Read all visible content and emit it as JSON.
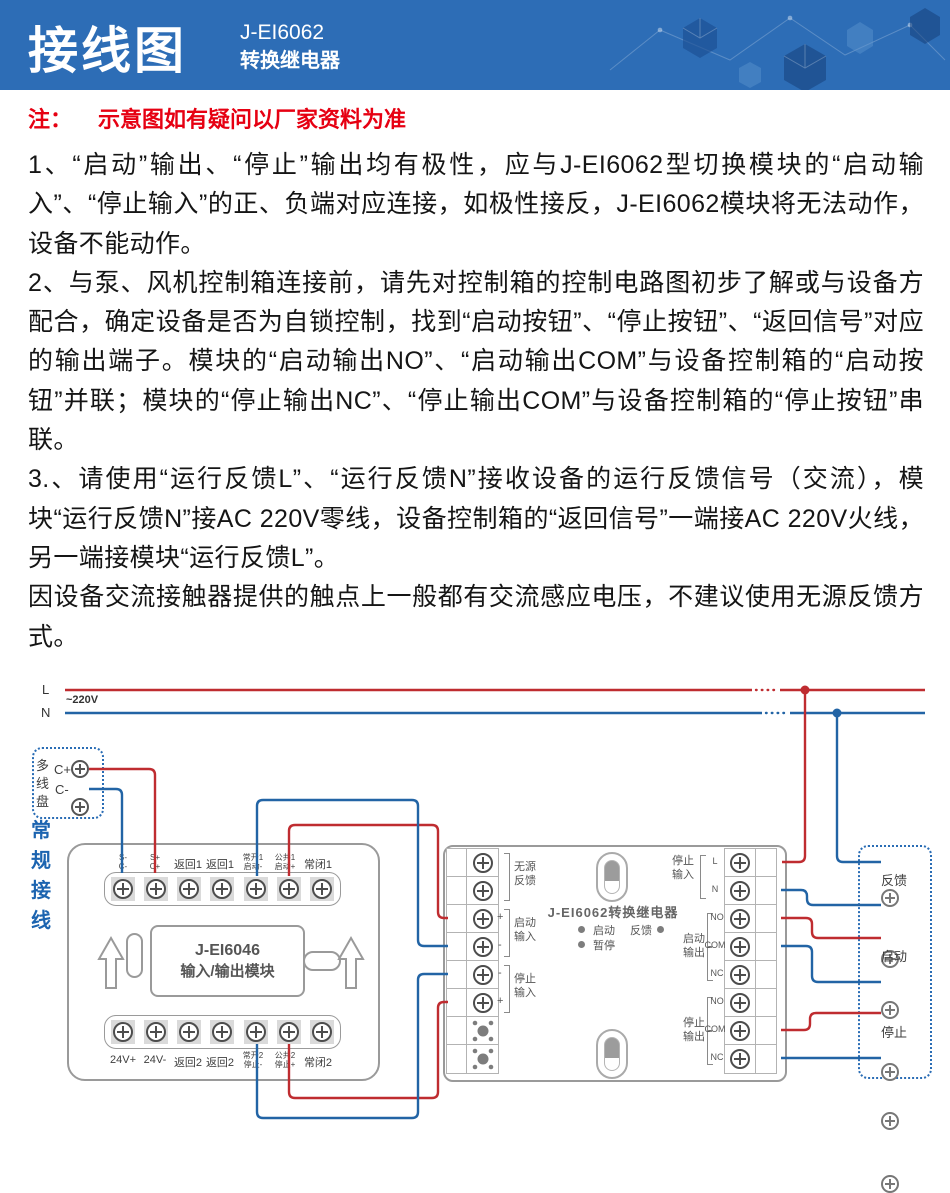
{
  "header": {
    "title": "接线图",
    "model": "J-EI6062",
    "model_type": "转换继电器",
    "bg_color": "#2d6db6"
  },
  "note": {
    "prefix": "注：",
    "text": "示意图如有疑问以厂家资料为准",
    "color": "#e60012"
  },
  "instructions": {
    "p1": "1、“启动”输出、“停止”输出均有极性，应与J-EI6062型切换模块的“启动输入”、“停止输入”的正、负端对应连接，如极性接反，J-EI6062模块将无法动作，设备不能动作。",
    "p2": "2、与泵、风机控制箱连接前，请先对控制箱的控制电路图初步了解或与设备方配合，确定设备是否为自锁控制，找到“启动按钮”、“停止按钮”、“返回信号”对应的输出端子。模块的“启动输出NO”、“启动输出COM”与设备控制箱的“启动按钮”并联；模块的“停止输出NC”、“停止输出COM”与设备控制箱的“停止按钮”串联。",
    "p3": "3.、请使用“运行反馈L”、“运行反馈N”接收设备的运行反馈信号（交流），模块“运行反馈N”接AC 220V零线，设备控制箱的“返回信号”一端接AC 220V火线，另一端接模块“运行反馈L”。",
    "p4": "因设备交流接触器提供的触点上一般都有交流感应电压，不建议使用无源反馈方式。"
  },
  "diagram": {
    "power": {
      "l": "L",
      "n": "N",
      "voltage": "~220V"
    },
    "wire_colors": {
      "live": "#bf2c30",
      "neutral": "#2264a5"
    },
    "multi_wire_panel": {
      "label_chars": [
        "多",
        "线",
        "盘"
      ],
      "terminals": [
        "C+",
        "C-"
      ]
    },
    "conventional_label_chars": [
      "常",
      "规",
      "接",
      "线"
    ],
    "io_module": {
      "title_line1": "J-EI6046",
      "title_line2": "输入/输出模块",
      "top_terminals": [
        {
          "line1": "S-",
          "line2": "C-"
        },
        {
          "line1": "S+",
          "line2": "C+"
        },
        {
          "line1": "返回1"
        },
        {
          "line1": "返回1"
        },
        {
          "line1": "常开1",
          "line2": "启动-"
        },
        {
          "line1": "公共1",
          "line2": "启动+"
        },
        {
          "line1": "常闭1"
        }
      ],
      "bottom_terminals": [
        {
          "line1": "24V+"
        },
        {
          "line1": "24V-"
        },
        {
          "line1": "返回2"
        },
        {
          "line1": "返回2"
        },
        {
          "line1": "常开2",
          "line2": "停止-"
        },
        {
          "line1": "公共2",
          "line2": "停止+"
        },
        {
          "line1": "常闭2"
        }
      ]
    },
    "relay_module": {
      "title": "J-EI6062转换继电器",
      "led_start": "启动",
      "led_feedback": "反馈",
      "led_pause": "暂停",
      "left_groups": [
        {
          "label_line1": "无源",
          "label_line2": "反馈"
        },
        {
          "label_line1": "启动",
          "label_line2": "输入",
          "mark_top": "+",
          "mark_bottom": "-"
        },
        {
          "label_line1": "停止",
          "label_line2": "输入",
          "mark_top": "-",
          "mark_bottom": "+"
        }
      ],
      "right_groups": [
        {
          "label_line1": "停止",
          "label_line2": "输入",
          "terminals": [
            "L",
            "N"
          ]
        },
        {
          "label_line1": "启动",
          "label_line2": "输出",
          "terminals": [
            "NO",
            "COM",
            "NC"
          ]
        },
        {
          "label_line1": "停止",
          "label_line2": "输出",
          "terminals": [
            "NO",
            "COM",
            "NC"
          ]
        }
      ]
    },
    "device_box": {
      "labels": [
        "反馈",
        "启动",
        "停止"
      ]
    }
  }
}
